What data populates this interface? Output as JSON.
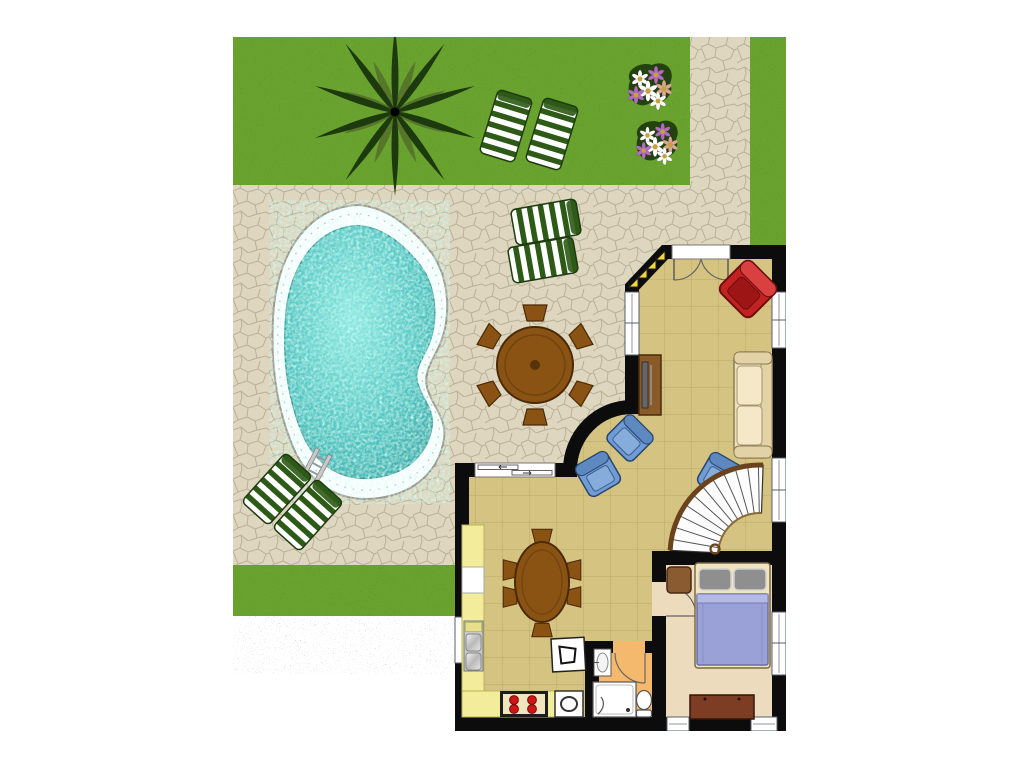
{
  "scene": {
    "type": "architectural floor plan",
    "view": "top-down",
    "subject": "holiday villa ground floor with garden, stone patio and kidney-shaped swimming pool"
  },
  "palette": {
    "grass": "#69a22f",
    "stone": "#ded6bf",
    "stoneLine": "#b3a98e",
    "water": "#4fc3c0",
    "waterLight": "#8fe8e2",
    "coping": "#ffffff",
    "wall": "#0c0c0c",
    "floorMain": "#d5c382",
    "floorBedroom": "#ecdcbd",
    "floorBath": "#f5b96e",
    "counter": "#f3ed9b",
    "wood": "#8a5313",
    "woodDark": "#4a2a06",
    "lounger": "#2d5a16",
    "sofa": "#eee0bc",
    "chairBlue": "#6f9cd4",
    "chairRed": "#c32222",
    "blanket": "#99a1d6",
    "pillow": "#8f8f8f",
    "steps": "#f2d937",
    "stainless": "#c9c9c9",
    "treeDark": "#1c3a0e",
    "treeLight": "#56762a",
    "fixture": "#ffffff"
  },
  "outdoor": {
    "garden": {
      "grass_areas": 3,
      "flower_beds": 2,
      "palm_trees": 1
    },
    "pool": {
      "shape": "kidney",
      "has_ladder": true
    },
    "sun_loungers": 6,
    "patio_dining": {
      "table": "round",
      "chairs": 6
    },
    "stone_paths": 1
  },
  "house": {
    "rooms": [
      {
        "name": "living-room",
        "items": [
          "french-doors",
          "corner-steps",
          "red-armchair",
          "cream-sofa",
          "tv-cabinet",
          "blue-armchair",
          "blue-armchair",
          "blue-armchair",
          "spiral-staircase"
        ]
      },
      {
        "name": "kitchen-dining",
        "items": [
          "sliding-door",
          "l-shaped-counter",
          "double-sink",
          "stove",
          "oven",
          "small-appliance",
          "oval-dining-table",
          "dining-chairs-x6"
        ]
      },
      {
        "name": "bedroom",
        "items": [
          "double-bed",
          "pillows-x2",
          "nightstand",
          "dresser",
          "interior-door"
        ]
      },
      {
        "name": "bathroom",
        "items": [
          "wash-basin",
          "shower",
          "toilet",
          "interior-door"
        ]
      }
    ],
    "windows": 7,
    "exterior_doors": 2
  }
}
